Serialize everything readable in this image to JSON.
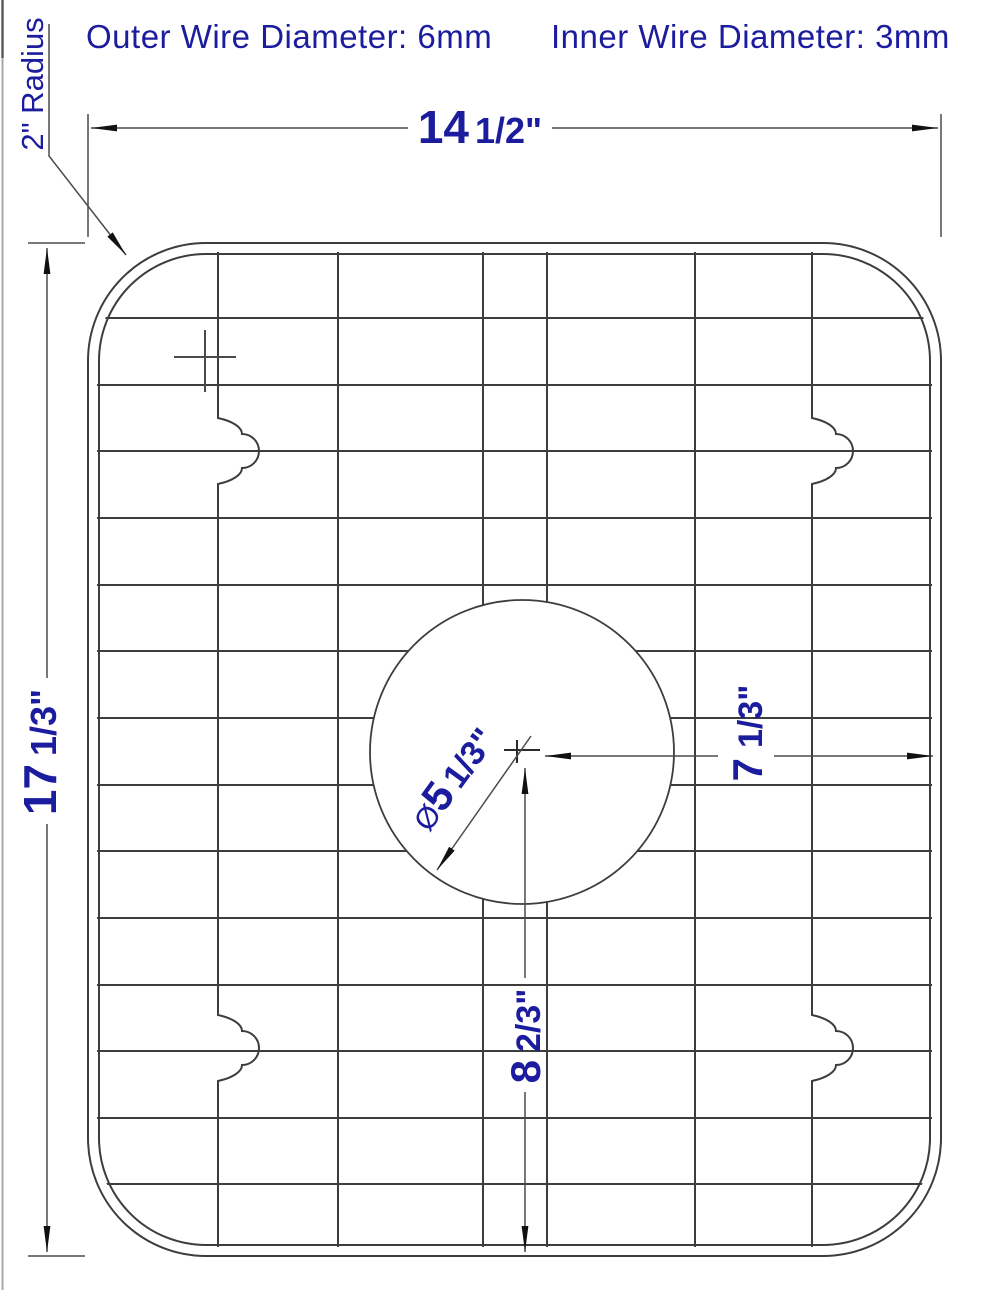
{
  "header": {
    "outer_wire_label": "Outer Wire Diameter: 6mm",
    "inner_wire_label": "Inner Wire Diameter: 3mm"
  },
  "dimensions": {
    "overall_width": {
      "whole": "14",
      "fraction": "1/2\""
    },
    "overall_height": {
      "whole": "17",
      "fraction": "1/3\""
    },
    "corner_radius_label": "2\" Radius",
    "drain_diameter": {
      "symbol": "Ø",
      "whole": "5",
      "fraction": "1/3\""
    },
    "center_to_right_edge": {
      "whole": "7",
      "fraction": "1/3\""
    },
    "center_to_bottom_edge": {
      "whole": "8",
      "fraction": "2/3\""
    }
  },
  "colors": {
    "label_blue": "#1c1c9e",
    "line_gray": "#3d3d3d",
    "dim_gray": "#4b4b4b",
    "artifact_gray": "#a8a8a8",
    "arrow_black": "#111111",
    "background": "#ffffff"
  }
}
